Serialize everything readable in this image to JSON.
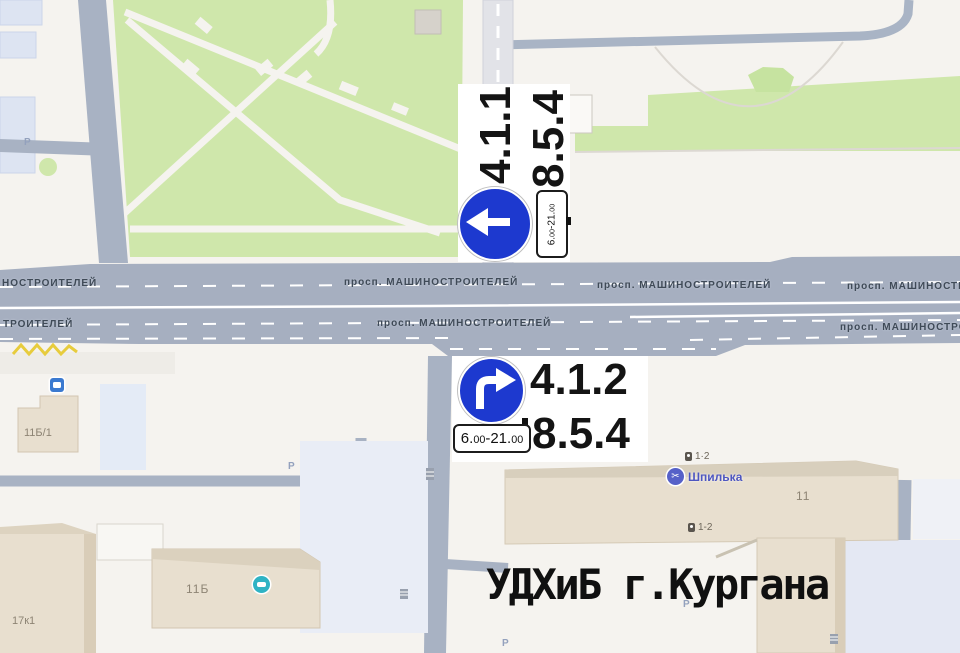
{
  "signs": {
    "sign1": {
      "code_primary": "4.1.1",
      "code_secondary": "8.5.4",
      "time": {
        "h1": "6.",
        "m1": "00",
        "h2": "-21.",
        "m2": "00"
      }
    },
    "sign2": {
      "code_primary": "4.1.2",
      "code_secondary": "8.5.4",
      "time": {
        "h1": "6.",
        "m1": "00",
        "h2": "-21.",
        "m2": "00"
      }
    }
  },
  "watermark": "УДХиБ г.Кургана",
  "streets": {
    "avenue_full": "просп. МАШИНОСТРОИТЕЛЕЙ",
    "avenue_cut_left_top": "НОСТРОИТЕЛЕЙ",
    "avenue_cut_left_bottom": "ТРОИТЕЛЕЙ",
    "avenue_cut_right_top": "просп. МАШИНОСТР",
    "avenue_cut_right_bottom": "просп. МАШИНОСТРО"
  },
  "labels": {
    "parking": "Р",
    "building_11b1": "11Б/1",
    "building_17k1": "17к1",
    "building_11b": "11Б",
    "building_11": "11",
    "entrance_top": "1·2",
    "entrance_bottom": "1-2",
    "place_shpilka": "Шпилька"
  },
  "colors": {
    "sign_blue": "#1d39cf",
    "road_gray": "#a6afc0",
    "park_green": "#cfe7ab",
    "building_beige": "#e8dfcf",
    "place_blue": "#4d56c0",
    "service_teal": "#2fb3c4",
    "bus_blue": "#3b7ad0"
  }
}
